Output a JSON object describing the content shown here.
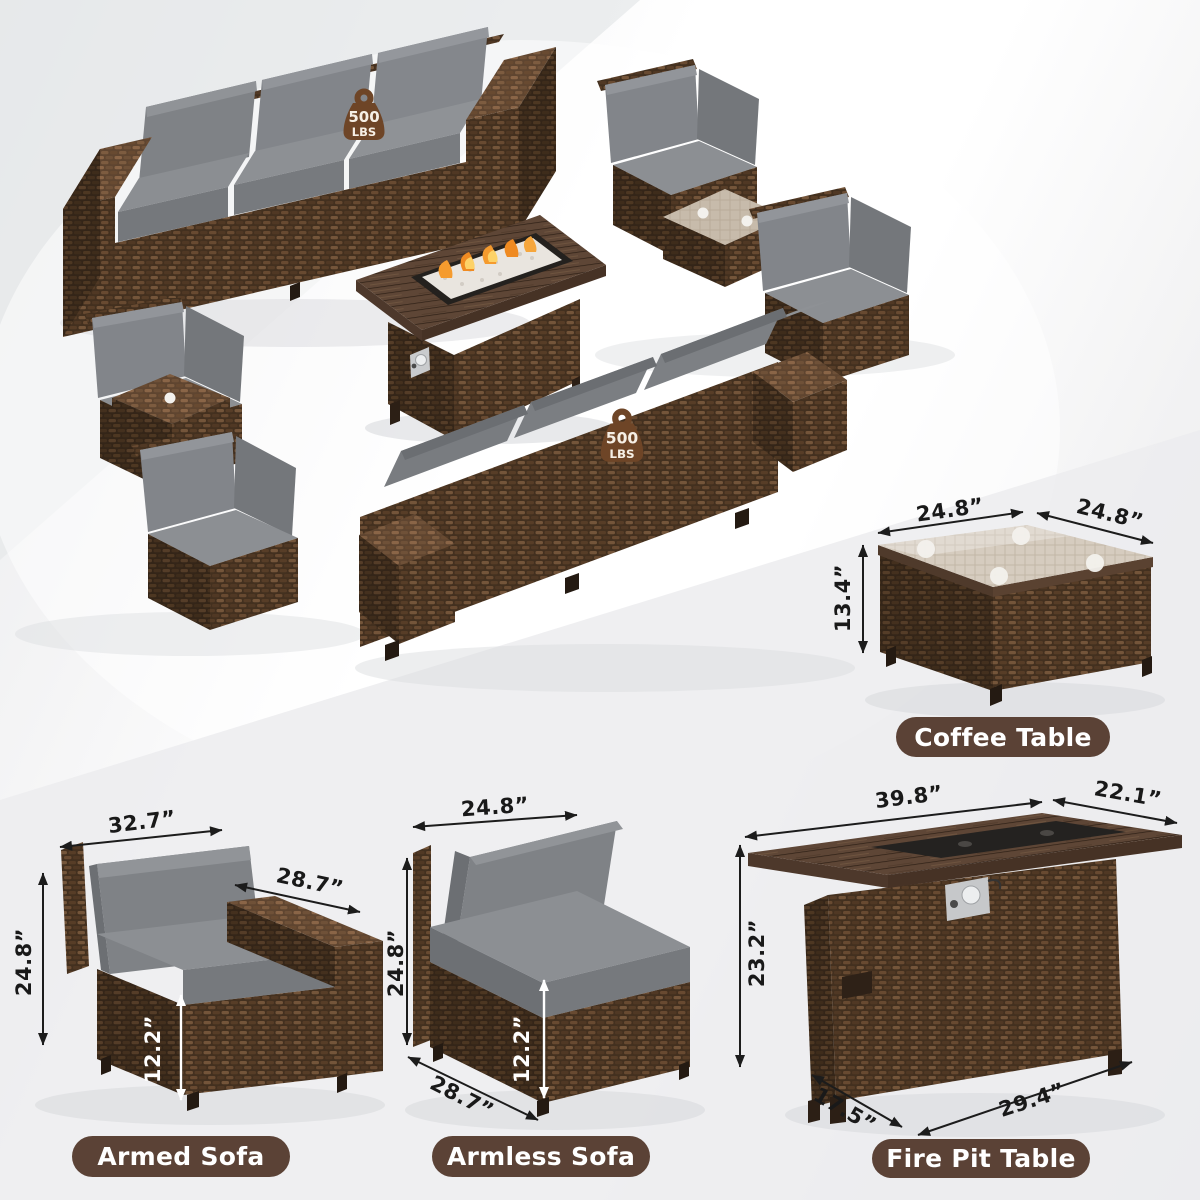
{
  "colors": {
    "label_pill_bg": "#5b4236",
    "label_pill_text": "#ffffff",
    "dimension_text": "#191919",
    "weight_badge": "#6e4527",
    "wicker_brown": "#4a3526",
    "wood_brown": "#5e4636",
    "cushion_gray": "#7e8184",
    "flame_orange": "#f59b2e"
  },
  "scene": {
    "weight_badge_value": "500",
    "weight_badge_unit": "LBS"
  },
  "panels": {
    "coffee_table": {
      "label": "Coffee Table",
      "dim_top_width": "24.8”",
      "dim_top_depth": "24.8”",
      "dim_height": "13.4”"
    },
    "armed_sofa": {
      "label": "Armed Sofa",
      "dim_width": "32.7”",
      "dim_depth": "28.7”",
      "dim_height": "24.8”",
      "dim_seat_height": "12.2”"
    },
    "armless_sofa": {
      "label": "Armless Sofa",
      "dim_width": "24.8”",
      "dim_height": "24.8”",
      "dim_seat_height": "12.2”",
      "dim_depth": "28.7”"
    },
    "fire_pit_table": {
      "label": "Fire Pit Table",
      "dim_top_width": "39.8”",
      "dim_top_depth": "22.1”",
      "dim_height": "23.2”",
      "dim_base_depth": "17.5”",
      "dim_base_width": "29.4”"
    }
  }
}
